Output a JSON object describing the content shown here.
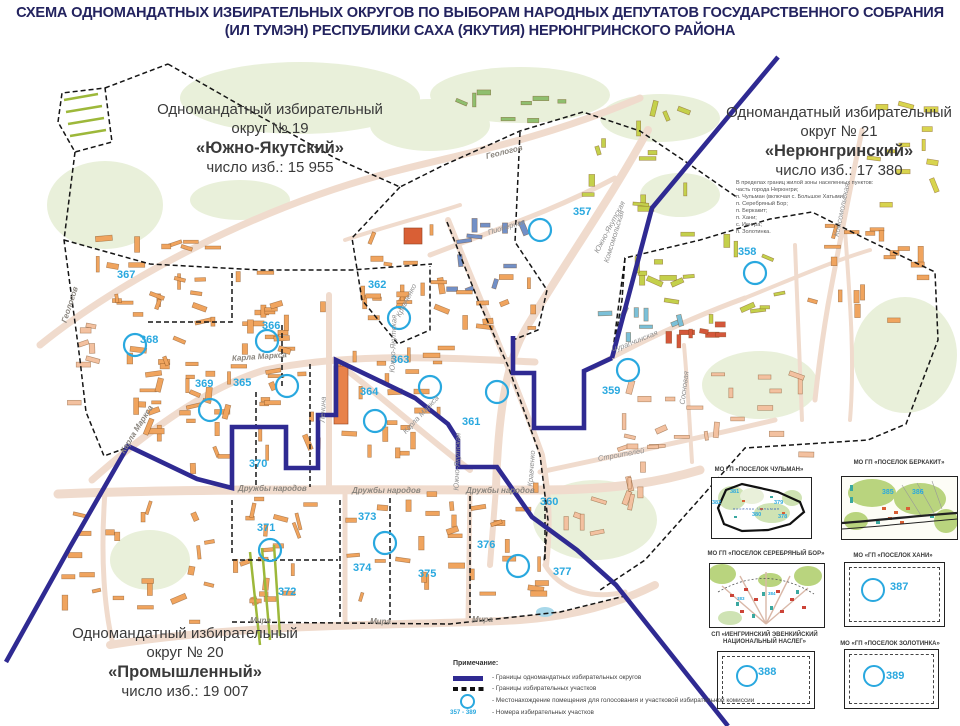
{
  "title": {
    "line1": "СХЕМА ОДНОМАНДАТНЫХ ИЗБИРАТЕЛЬНЫХ ОКРУГОВ ПО ВЫБОРАМ НАРОДНЫХ ДЕПУТАТОВ ГОСУДАРСТВЕННОГО СОБРАНИЯ",
    "line2": "(ИЛ ТУМЭН) РЕСПУБЛИКИ САХА (ЯКУТИЯ) НЕРЮНГРИНСКОГО РАЙОНА"
  },
  "districts": {
    "d19": {
      "line1": "Одномандатный избирательный",
      "line2": "округ № 19",
      "name": "«Южно-Якутский»",
      "voters": "число изб.: 15 955"
    },
    "d21": {
      "line1": "Одномандатный избирательный",
      "line2": "округ № 21",
      "name": "«Нерюнгринский»",
      "voters": "число изб.: 17 380",
      "note": [
        "В пределах границ жилой зоны населенных пунктов:",
        "часть города Нерюнгри;",
        "п. Чульман (включая с. Большое Хатыми);",
        "п. Серебряный Бор;",
        "п. Беркакит;",
        "п. Хани;",
        "с. Иенгра;",
        "п. Золотинка."
      ]
    },
    "d20": {
      "line1": "Одномандатный избирательный",
      "line2": "округ № 20",
      "name": "«Промышленный»",
      "voters": "число изб.: 19 007"
    }
  },
  "map": {
    "precinct_numbers": [
      "357",
      "358",
      "359",
      "360",
      "361",
      "362",
      "363",
      "364",
      "365",
      "366",
      "367",
      "368",
      "369",
      "370",
      "371",
      "372",
      "373",
      "374",
      "375",
      "376",
      "377"
    ],
    "street_labels": [
      "Геологов",
      "Геологов",
      "Пионерная",
      "Южно-Якутская",
      "Южно-Якутская",
      "Южно-Якутская",
      "Комсомольская",
      "Комсомольская",
      "Кравченко",
      "Кравченко",
      "Карла Маркса",
      "Карла Маркса",
      "Карла Маркса",
      "Ленина",
      "Дружбы народов",
      "Дружбы народов",
      "Дружбы народов",
      "Строителей",
      "Чурапчинская",
      "Сосновая",
      "Мира",
      "Мира",
      "Мира"
    ]
  },
  "insets": {
    "chulman": {
      "title": "МО ГП «ПОСЕЛОК ЧУЛЬМАН»",
      "place": "поселок Чульман",
      "numbers": [
        "381",
        "382",
        "379",
        "380",
        "378"
      ]
    },
    "berkakit": {
      "title": "МО ГП «ПОСЕЛОК БЕРКАКИТ»",
      "numbers": [
        "385",
        "386"
      ]
    },
    "serebryany_bor": {
      "title": "МО ГП «ПОСЕЛОК СЕРЕБРЯНЫЙ БОР»",
      "numbers": [
        "383",
        "384"
      ]
    },
    "khani": {
      "title": "МО «ГП «ПОСЕЛОК ХАНИ»",
      "numbers": [
        "387"
      ]
    },
    "iengra": {
      "title": "СП «ИЕНГРИНСКИЙ ЭВЕНКИЙСКИЙ",
      "title2": "НАЦИОНАЛЬНЫЙ НАСЛЕГ»",
      "numbers": [
        "388"
      ]
    },
    "zolotinka": {
      "title": "МО «ГП «ПОСЕЛОК ЗОЛОТИНКА»",
      "numbers": [
        "389"
      ]
    }
  },
  "legend": {
    "heading": "Примечание:",
    "items": [
      {
        "label": "- Границы одномандатных избирательных округов"
      },
      {
        "label": "- Границы избирательных участков"
      },
      {
        "label": "- Местонахождение помещения для голосования и участковой избирательной комиссии"
      },
      {
        "symbol": "357 - 389",
        "label": "- Номера избирательных участков"
      }
    ]
  },
  "colors": {
    "district_boundary": "#2f2a92",
    "precinct_number": "#29a8df",
    "polling_circle": "#29a8df",
    "building_orange": "#f0a45e",
    "street": "#f0dbcd"
  }
}
